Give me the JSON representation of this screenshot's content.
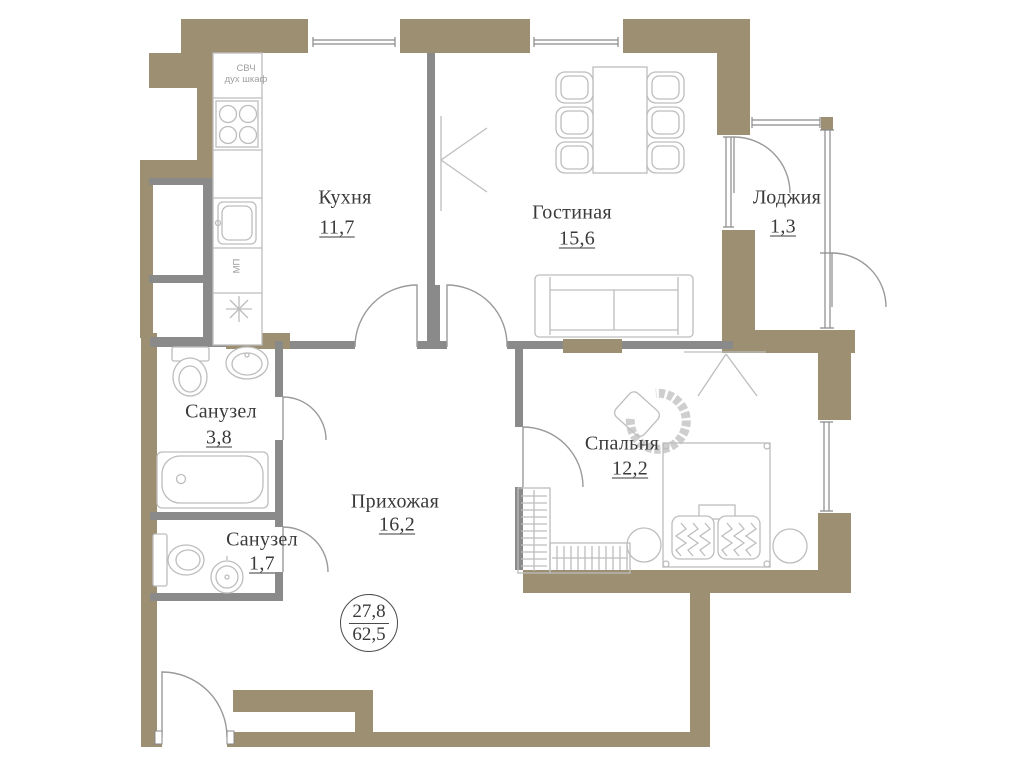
{
  "colors": {
    "wall": "#9C8F72",
    "partition": "#8A8A8A",
    "furn": "#BDBDBD",
    "door": "#9A9A9A",
    "text": "#3A3A3A",
    "subtext": "#A0A0A0"
  },
  "rooms": {
    "kitchen": {
      "name": "Кухня",
      "area": "11,7"
    },
    "living_room": {
      "name": "Гостиная",
      "area": "15,6"
    },
    "loggia": {
      "name": "Лоджия",
      "area": "1,3"
    },
    "bathroom_large": {
      "name": "Санузел",
      "area": "3,8"
    },
    "bathroom_small": {
      "name": "Санузел",
      "area": "1,7"
    },
    "hallway": {
      "name": "Прихожая",
      "area": "16,2"
    },
    "bedroom": {
      "name": "Спальня",
      "area": "12,2"
    }
  },
  "area_badge": {
    "living": "27,8",
    "total": "62,5"
  },
  "kitchen_annotations": {
    "line1": "СВЧ",
    "line2": "дух шкаф",
    "dishwasher": "МП"
  }
}
